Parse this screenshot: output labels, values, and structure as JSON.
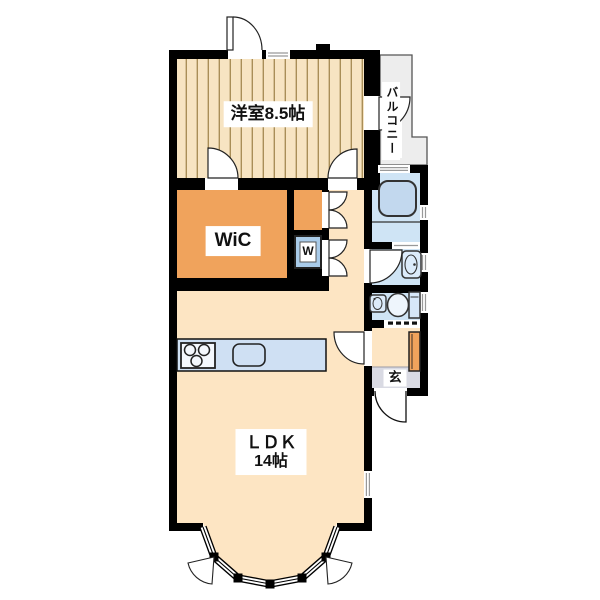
{
  "plan": {
    "type": "floor-plan",
    "bedroom_label": "洋室8.5帖",
    "balcony_label": "バルコニー",
    "wic_label": "WiC",
    "washer_label": "W",
    "ldk_label": "ＬＤＫ",
    "ldk_size": "14帖",
    "entrance_label": "玄"
  },
  "colors": {
    "wall": "#000000",
    "wood-floor": "#f7e4c2",
    "wood-stripe": "#a98e58",
    "orange": "#f0a35c",
    "peach": "#fde5c3",
    "bath-blue": "#cfe4f5",
    "counter-blue": "#cfe0f3",
    "washer-blue": "#a9cbe9",
    "balcony-gray": "#ededed",
    "genkan-gray": "#d9dae3"
  }
}
